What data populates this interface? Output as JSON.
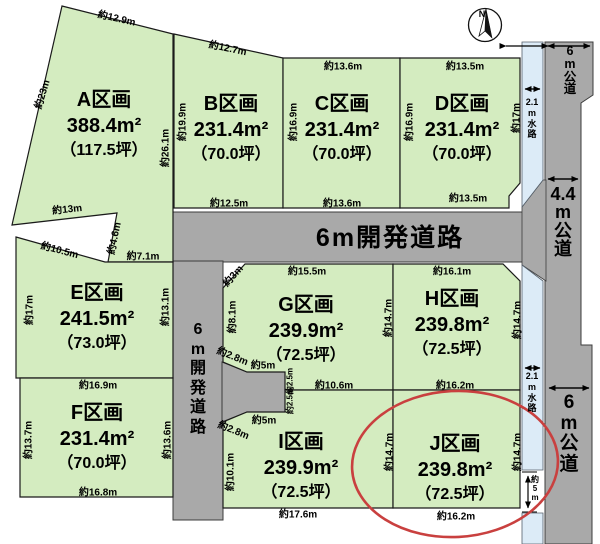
{
  "compass": {
    "north_label": "N"
  },
  "plots": {
    "a": {
      "name": "A区画",
      "area": "388.4m²",
      "tsubo": "（117.5坪）"
    },
    "b": {
      "name": "B区画",
      "area": "231.4m²",
      "tsubo": "（70.0坪）"
    },
    "c": {
      "name": "C区画",
      "area": "231.4m²",
      "tsubo": "（70.0坪）"
    },
    "d": {
      "name": "D区画",
      "area": "231.4m²",
      "tsubo": "（70.0坪）"
    },
    "e": {
      "name": "E区画",
      "area": "241.5m²",
      "tsubo": "（73.0坪）"
    },
    "f": {
      "name": "F区画",
      "area": "231.4m²",
      "tsubo": "（70.0坪）"
    },
    "g": {
      "name": "G区画",
      "area": "239.9m²",
      "tsubo": "（72.5坪）"
    },
    "h": {
      "name": "H区画",
      "area": "239.8m²",
      "tsubo": "（72.5坪）"
    },
    "i": {
      "name": "I区画",
      "area": "239.9m²",
      "tsubo": "（72.5坪）"
    },
    "j": {
      "name": "J区画",
      "area": "239.8m²",
      "tsubo": "（72.5坪）"
    }
  },
  "roads": {
    "dev_road_horizontal": "6m開発道路",
    "dev_road_vertical": "6\nm\n開\n発\n道\n路",
    "public_road_top": "6\nm\n公\n道",
    "public_road_mid": "4.4\nm\n公\n道",
    "public_road_bottom": "6\nm\n公\n道",
    "waterway_top": "2.1\nm\n水\n路",
    "waterway_bottom": "2.1\nm\n水\n路",
    "waterway_gap": "約\n5\nm"
  },
  "dimensions": {
    "a_top": "約12.9m",
    "a_left": "約23m",
    "a_right": "約26.1m",
    "a_bottom": "約13m",
    "b_top": "約12.7m",
    "b_left": "約19.9m",
    "b_bottom": "約12.5m",
    "c_top": "約13.6m",
    "c_left": "約16.9m",
    "c_bottom": "約13.6m",
    "d_top": "約13.5m",
    "d_left": "約16.9m",
    "d_right": "約17m",
    "d_bottom": "約13.5m",
    "e_diag": "約10.5m",
    "e_notch": "約4.6m",
    "e_top": "約7.1m",
    "e_left": "約17m",
    "e_right": "約13.1m",
    "f_top": "約16.9m",
    "f_left": "約13.7m",
    "f_right": "約13.6m",
    "f_bottom": "約16.8m",
    "g_top": "約15.5m",
    "g_corner": "約3m",
    "g_left": "約8.1m",
    "g_diag": "約2.8m",
    "g_step": "約5m",
    "g_step2": "約2.5m",
    "g_bottom": "約10.6m",
    "g_right": "約14.7m",
    "h_top": "約16.1m",
    "h_right": "約14.7m",
    "h_bottom": "約16.2m",
    "i_diag": "約2.8m",
    "i_step": "約5m",
    "i_step2": "約2.5m",
    "i_left": "約10.1m",
    "i_bottom": "約17.6m",
    "i_right": "約14.7m",
    "j_right": "約14.7m",
    "j_bottom": "約16.2m"
  },
  "colors": {
    "plot_green": "#d4ecc0",
    "road_gray": "#a9a9a9",
    "waterway_blue": "#dcebf7",
    "highlight_red": "#c9403f"
  }
}
